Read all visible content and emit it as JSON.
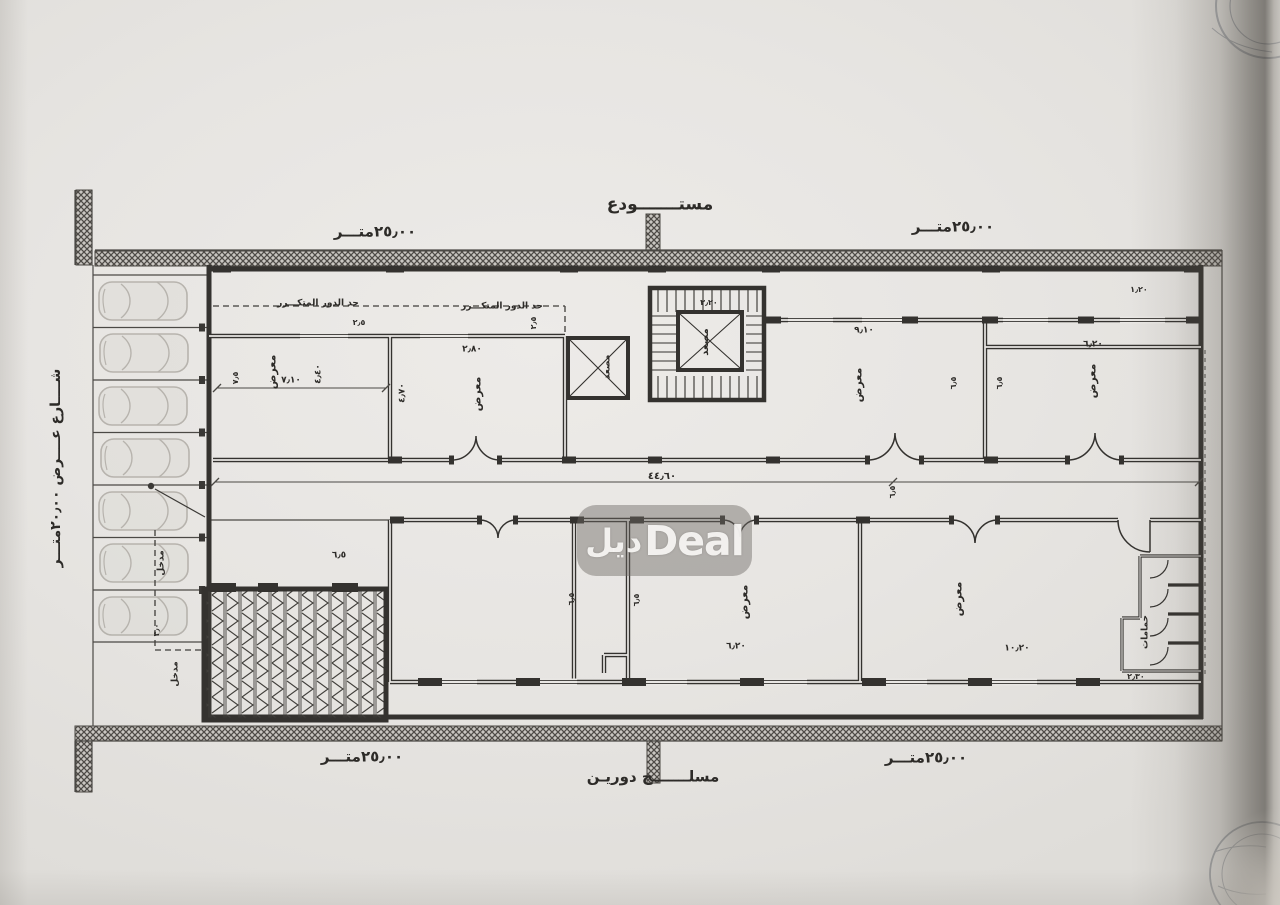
{
  "watermark": {
    "arabic": "ديل",
    "latin": "Deal"
  },
  "plan": {
    "parking_spaces": 7,
    "annotations": [
      {
        "t": "مستـــــــودع",
        "x": 660,
        "y": 205,
        "s": 17,
        "n": "storage-label"
      },
      {
        "t": "٢٥٫٠٠متـــر",
        "x": 375,
        "y": 232,
        "s": 15,
        "n": "dim-top-left"
      },
      {
        "t": "٢٥٫٠٠متـــر",
        "x": 953,
        "y": 227,
        "s": 15,
        "n": "dim-top-right"
      },
      {
        "t": "٢٥٫٠٠متـــر",
        "x": 362,
        "y": 757,
        "s": 15,
        "n": "dim-bottom-left"
      },
      {
        "t": "٢٥٫٠٠متـــر",
        "x": 926,
        "y": 758,
        "s": 15,
        "n": "dim-bottom-right"
      },
      {
        "t": "مسلـــــــح دوريـن",
        "x": 653,
        "y": 777,
        "s": 15,
        "n": "structure-label"
      },
      {
        "t": "شــــارع عــــرض ٢٠٫٠٠متـــر",
        "x": 56,
        "y": 468,
        "s": 14,
        "r": -90,
        "n": "street-label"
      },
      {
        "t": "حد الدور المتكـــرر",
        "x": 318,
        "y": 304,
        "s": 9,
        "n": "setback-label"
      },
      {
        "t": "حد الدور المتكـــرر",
        "x": 502,
        "y": 307,
        "s": 9,
        "n": "setback-label"
      },
      {
        "t": "معرض",
        "x": 272,
        "y": 372,
        "s": 11,
        "r": -90,
        "n": "room-label"
      },
      {
        "t": "معرض",
        "x": 477,
        "y": 394,
        "s": 11,
        "r": -90,
        "n": "room-label"
      },
      {
        "t": "معرض",
        "x": 858,
        "y": 385,
        "s": 11,
        "r": -90,
        "n": "room-label"
      },
      {
        "t": "معرض",
        "x": 1092,
        "y": 381,
        "s": 11,
        "r": -90,
        "n": "room-label"
      },
      {
        "t": "معرض",
        "x": 744,
        "y": 602,
        "s": 11,
        "r": -90,
        "n": "room-label"
      },
      {
        "t": "معرض",
        "x": 958,
        "y": 599,
        "s": 11,
        "r": -90,
        "n": "room-label"
      },
      {
        "t": "مصعد",
        "x": 608,
        "y": 367,
        "s": 9,
        "r": -90,
        "n": "elevator-label"
      },
      {
        "t": "مصعد",
        "x": 706,
        "y": 342,
        "s": 10,
        "r": -90,
        "n": "elevator-label"
      },
      {
        "t": "حمامات",
        "x": 1146,
        "y": 632,
        "s": 9,
        "r": -90,
        "n": "bathrooms-label"
      },
      {
        "t": "مدخل",
        "x": 162,
        "y": 563,
        "s": 9,
        "r": -90,
        "n": "entrance-label"
      },
      {
        "t": "مدخل",
        "x": 176,
        "y": 674,
        "s": 9,
        "r": -90,
        "n": "entrance-label"
      },
      {
        "t": "٧٫١٠",
        "x": 291,
        "y": 381,
        "s": 9,
        "n": "dim"
      },
      {
        "t": "٤٫٤٠",
        "x": 319,
        "y": 374,
        "s": 9,
        "r": -90,
        "n": "dim"
      },
      {
        "t": "٧٫٥",
        "x": 236,
        "y": 378,
        "s": 8,
        "r": -90,
        "n": "dim"
      },
      {
        "t": "٤٫٧٠",
        "x": 403,
        "y": 393,
        "s": 9,
        "r": -90,
        "n": "dim"
      },
      {
        "t": "٢٫٨٠",
        "x": 472,
        "y": 350,
        "s": 9,
        "n": "dim"
      },
      {
        "t": "٢٫٥",
        "x": 359,
        "y": 323,
        "s": 8,
        "n": "dim"
      },
      {
        "t": "٢٫٥",
        "x": 534,
        "y": 323,
        "s": 8,
        "r": -90,
        "n": "dim"
      },
      {
        "t": "٣٫٢٠",
        "x": 709,
        "y": 303,
        "s": 8,
        "n": "dim"
      },
      {
        "t": "١٫٢٠",
        "x": 1139,
        "y": 290,
        "s": 8,
        "n": "dim"
      },
      {
        "t": "٩٫١٠",
        "x": 864,
        "y": 331,
        "s": 9,
        "n": "dim"
      },
      {
        "t": "٦٫٢٠",
        "x": 1093,
        "y": 345,
        "s": 9,
        "n": "dim"
      },
      {
        "t": "٦٫٥",
        "x": 954,
        "y": 383,
        "s": 8,
        "r": -90,
        "n": "dim"
      },
      {
        "t": "٦٫٥",
        "x": 1000,
        "y": 383,
        "s": 8,
        "r": -90,
        "n": "dim"
      },
      {
        "t": "٤٤٫٦٠",
        "x": 662,
        "y": 477,
        "s": 10,
        "n": "dim"
      },
      {
        "t": "٦٫٥",
        "x": 893,
        "y": 492,
        "s": 8,
        "r": -90,
        "n": "dim"
      },
      {
        "t": "٦٫٥",
        "x": 572,
        "y": 599,
        "s": 8,
        "r": -90,
        "n": "dim"
      },
      {
        "t": "٦٫٥",
        "x": 637,
        "y": 600,
        "s": 8,
        "r": -90,
        "n": "dim"
      },
      {
        "t": "٦٫٢٠",
        "x": 736,
        "y": 647,
        "s": 9,
        "n": "dim"
      },
      {
        "t": "١٠٫٢٠",
        "x": 1017,
        "y": 649,
        "s": 9,
        "n": "dim"
      },
      {
        "t": "٢٫٣٠",
        "x": 1136,
        "y": 677,
        "s": 8,
        "n": "dim"
      },
      {
        "t": "٦٫٥",
        "x": 339,
        "y": 556,
        "s": 9,
        "n": "dim"
      },
      {
        "t": "٣٫٠",
        "x": 157,
        "y": 630,
        "s": 8,
        "r": -90,
        "n": "dim"
      }
    ]
  }
}
